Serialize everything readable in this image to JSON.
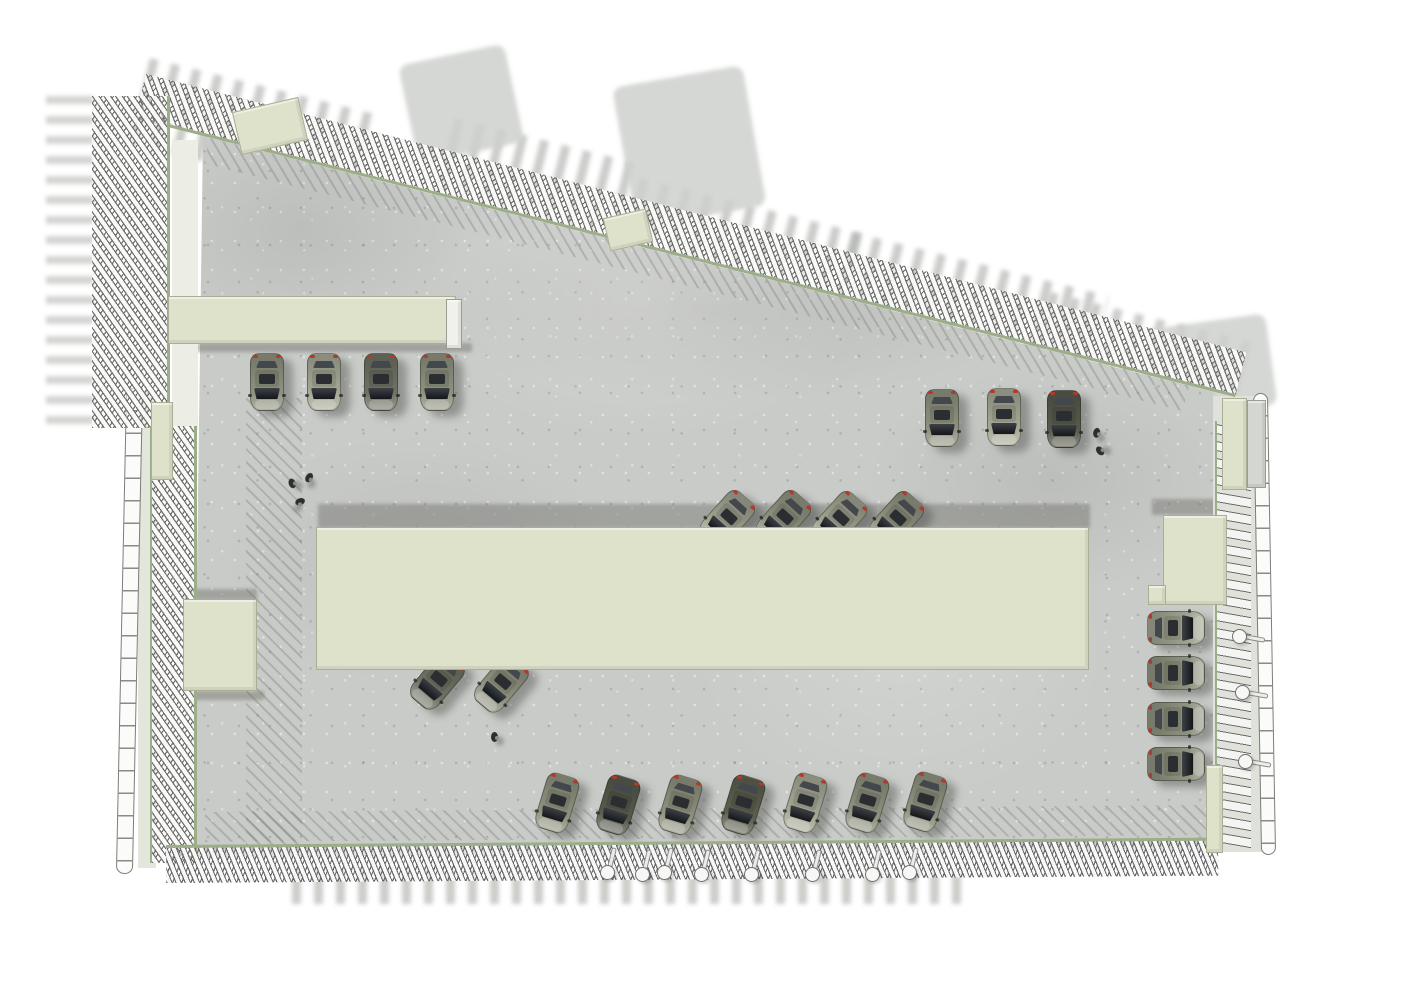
{
  "scene": {
    "description": "axonometric top view rendering of a parking level with louvered facades",
    "palette": {
      "background": "#ffffff",
      "concrete": "#c9cbc8",
      "cream_volume": "#dfe2cb",
      "louver_rail_green": "#9cae88",
      "louver_slat_white": "#f5f5f3",
      "shadow_gray": "#9a9c97",
      "ghost_gray": "#d5d7d3",
      "glass_dark": "#1c1f22",
      "taillight_red": "#b8372c"
    },
    "counts": {
      "cars": 24,
      "people": 6,
      "columns_bottom": 8,
      "columns_right": 3,
      "service_volumes": 10
    },
    "ghosts": [
      {
        "name": "ghost-louver-shadow-top-1",
        "kind": "bars",
        "x": 150,
        "y": 58,
        "w": 235,
        "h": 88,
        "rot": 14
      },
      {
        "name": "ghost-louver-shadow-top-2",
        "kind": "bars",
        "x": 455,
        "y": 118,
        "w": 185,
        "h": 84,
        "rot": 14
      },
      {
        "name": "ghost-louver-shadow-top-3",
        "kind": "bars",
        "x": 640,
        "y": 178,
        "w": 230,
        "h": 92,
        "rot": 14
      },
      {
        "name": "ghost-louver-shadow-top-4",
        "kind": "bars",
        "x": 852,
        "y": 232,
        "w": 265,
        "h": 92,
        "rot": 14
      },
      {
        "name": "ghost-louver-shadow-top-5",
        "kind": "bars",
        "x": 1050,
        "y": 292,
        "w": 215,
        "h": 100,
        "rot": 14
      },
      {
        "name": "ghost-box-shadow-a",
        "kind": "blob",
        "x": 398,
        "y": 66,
        "w": 108,
        "h": 100,
        "rot": -12
      },
      {
        "name": "ghost-box-shadow-b",
        "kind": "blob",
        "x": 612,
        "y": 88,
        "w": 132,
        "h": 142,
        "rot": -10
      },
      {
        "name": "ghost-box-shadow-c",
        "kind": "blob",
        "x": 1146,
        "y": 330,
        "w": 120,
        "h": 92,
        "rot": -8
      },
      {
        "name": "ghost-lattice-shadow-left",
        "kind": "bars",
        "dir": "v",
        "x": 46,
        "y": 88,
        "w": 48,
        "h": 336,
        "rot": 0
      },
      {
        "name": "ghost-louver-shadow-bottom",
        "kind": "bars",
        "x": 292,
        "y": 870,
        "w": 680,
        "h": 34,
        "rot": 0
      }
    ],
    "hatches": [
      {
        "name": "louver-shadow-strip-top",
        "x": 210,
        "y": 138,
        "w": 1010,
        "h": 26,
        "rot": 14.2
      },
      {
        "name": "louver-shadow-strip-left",
        "x": 246,
        "y": 398,
        "w": 56,
        "h": 447,
        "rot": 0
      },
      {
        "name": "louver-shadow-strip-bottom",
        "x": 205,
        "y": 812,
        "w": 1005,
        "h": 30,
        "rot": -0.4
      }
    ],
    "shadowbands": [
      {
        "name": "central-hall-shadow",
        "x": 318,
        "y": 504,
        "w": 772,
        "h": 24
      },
      {
        "name": "left-canopy-shadow",
        "x": 180,
        "y": 343,
        "w": 292,
        "h": 9
      },
      {
        "name": "left-box-shadow-top",
        "x": 185,
        "y": 589,
        "w": 72,
        "h": 11
      },
      {
        "name": "left-box-shadow-bottom",
        "x": 190,
        "y": 691,
        "w": 74,
        "h": 9
      },
      {
        "name": "right-box-shadow",
        "x": 1152,
        "y": 499,
        "w": 80,
        "h": 16
      }
    ],
    "buildings": [
      {
        "name": "central-hall",
        "x": 316,
        "y": 527,
        "w": 773,
        "h": 143
      },
      {
        "name": "left-canopy",
        "x": 168,
        "y": 296,
        "w": 288,
        "h": 48
      },
      {
        "name": "canopy-endcap",
        "x": 446,
        "y": 299,
        "w": 16,
        "h": 50,
        "color": "#f0f1ec",
        "border": "#9a9c98"
      },
      {
        "name": "left-box",
        "x": 183,
        "y": 599,
        "w": 74,
        "h": 92
      },
      {
        "name": "right-box",
        "x": 1163,
        "y": 515,
        "w": 64,
        "h": 90
      },
      {
        "name": "right-box-ledge",
        "x": 1148,
        "y": 585,
        "w": 18,
        "h": 20
      },
      {
        "name": "top-box-a",
        "x": 236,
        "y": 104,
        "w": 68,
        "h": 44,
        "rot": -13
      },
      {
        "name": "top-box-b",
        "x": 606,
        "y": 213,
        "w": 44,
        "h": 34,
        "rot": -13
      },
      {
        "name": "left-wall-segment",
        "x": 151,
        "y": 402,
        "w": 22,
        "h": 78
      },
      {
        "name": "bottom-right-wall",
        "x": 1206,
        "y": 765,
        "w": 17,
        "h": 88
      },
      {
        "name": "top-right-wall",
        "x": 1222,
        "y": 398,
        "w": 25,
        "h": 92
      },
      {
        "name": "top-right-gray-wall",
        "x": 1247,
        "y": 400,
        "w": 19,
        "h": 88,
        "color": "#d4d6d2",
        "border": "#9a9c98"
      }
    ],
    "cars": [
      {
        "x": 267,
        "y": 382,
        "rot": 180,
        "c": "#8f927f"
      },
      {
        "x": 324,
        "y": 382,
        "rot": 180,
        "c": "#a6a895"
      },
      {
        "x": 381,
        "y": 382,
        "rot": 180,
        "c": "#6f7263"
      },
      {
        "x": 437,
        "y": 382,
        "rot": 180,
        "c": "#8f927f"
      },
      {
        "x": 942,
        "y": 418,
        "rot": 180,
        "c": "#8f927f"
      },
      {
        "x": 1004,
        "y": 417,
        "rot": 180,
        "c": "#a6a895"
      },
      {
        "x": 1064,
        "y": 419,
        "rot": 180,
        "c": "#575a4c"
      },
      {
        "x": 1176,
        "y": 628,
        "rot": 90,
        "c": "#9fa28f"
      },
      {
        "x": 1176,
        "y": 673,
        "rot": 90,
        "c": "#8f927f"
      },
      {
        "x": 1176,
        "y": 719,
        "rot": 90,
        "c": "#8f927f"
      },
      {
        "x": 1176,
        "y": 764,
        "rot": 90,
        "c": "#8f927f"
      },
      {
        "x": 727,
        "y": 519,
        "rot": 222,
        "c": "#9fa28f"
      },
      {
        "x": 783,
        "y": 519,
        "rot": 222,
        "c": "#8f927f"
      },
      {
        "x": 839,
        "y": 520,
        "rot": 222,
        "c": "#9fa28f"
      },
      {
        "x": 896,
        "y": 520,
        "rot": 222,
        "c": "#8f927f"
      },
      {
        "x": 437,
        "y": 681,
        "rot": 220,
        "c": "#6f7263"
      },
      {
        "x": 501,
        "y": 684,
        "rot": 220,
        "c": "#8f927f"
      },
      {
        "x": 557,
        "y": 803,
        "rot": 197,
        "c": "#8f927f"
      },
      {
        "x": 618,
        "y": 805,
        "rot": 197,
        "c": "#575a4c"
      },
      {
        "x": 680,
        "y": 805,
        "rot": 197,
        "c": "#8f927f"
      },
      {
        "x": 743,
        "y": 805,
        "rot": 197,
        "c": "#5d604f"
      },
      {
        "x": 805,
        "y": 803,
        "rot": 197,
        "c": "#a6a895"
      },
      {
        "x": 867,
        "y": 803,
        "rot": 197,
        "c": "#8f927f"
      },
      {
        "x": 925,
        "y": 802,
        "rot": 197,
        "c": "#8f927f"
      }
    ],
    "people": [
      {
        "x": 293,
        "y": 484,
        "rot": -20
      },
      {
        "x": 309,
        "y": 479,
        "rot": 30
      },
      {
        "x": 299,
        "y": 503,
        "rot": 70
      },
      {
        "x": 1097,
        "y": 434,
        "rot": 10
      },
      {
        "x": 1101,
        "y": 451,
        "rot": -40
      },
      {
        "x": 495,
        "y": 738,
        "rot": 0
      }
    ],
    "columns": [
      {
        "x": 608,
        "y": 873,
        "stem": 14
      },
      {
        "x": 643,
        "y": 875,
        "stem": 14
      },
      {
        "x": 665,
        "y": 873,
        "stem": 14
      },
      {
        "x": 702,
        "y": 875,
        "stem": 14
      },
      {
        "x": 752,
        "y": 875,
        "stem": 14
      },
      {
        "x": 813,
        "y": 875,
        "stem": 14
      },
      {
        "x": 873,
        "y": 875,
        "stem": 14
      },
      {
        "x": 910,
        "y": 873,
        "stem": 14
      },
      {
        "x": 1240,
        "y": 637,
        "stem": 100
      },
      {
        "x": 1243,
        "y": 693,
        "stem": 100
      },
      {
        "x": 1246,
        "y": 762,
        "stem": 100
      }
    ]
  }
}
